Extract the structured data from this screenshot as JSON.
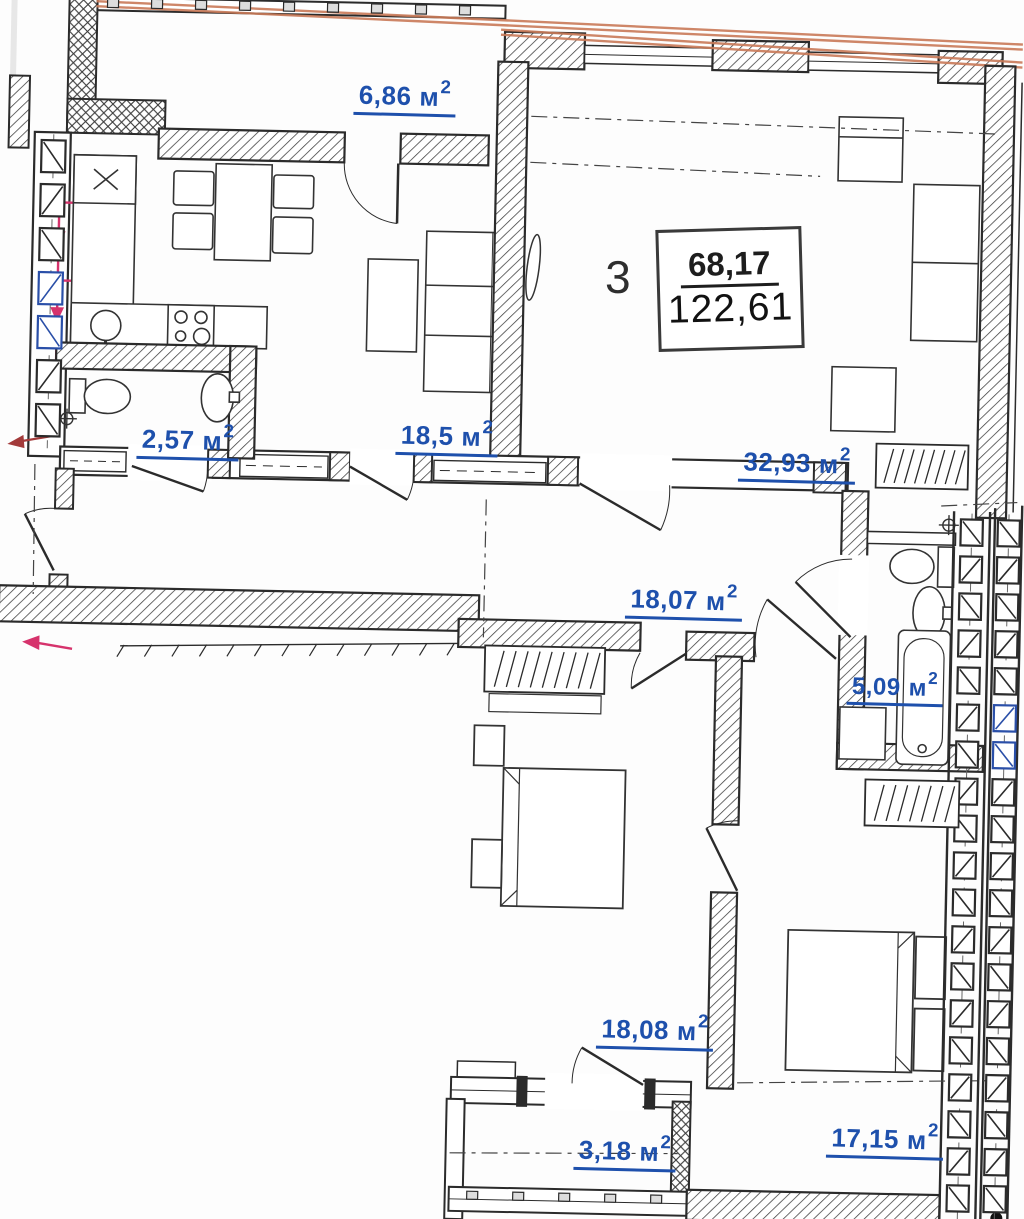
{
  "colors": {
    "area_label_blue": "#1e50ac",
    "facade_line_orange": "#c97a58",
    "plumbing_pink": "#d6336c",
    "entrance_arrow_red": "#a33a3a",
    "window_symbol_blue": "#2a4fa8",
    "drawing_black": "#2b2b2b"
  },
  "sup": "2",
  "apartment": {
    "rooms_count": "3",
    "living_area": "68,17",
    "total_area": "122,61"
  },
  "rooms": {
    "balcony_top": {
      "name": "balcony-top",
      "area": "6,86",
      "unit": "м"
    },
    "wc": {
      "name": "wc",
      "area": "2,57",
      "unit": "м"
    },
    "kitchen_living": {
      "name": "kitchen-living",
      "area": "18,5",
      "unit": "м"
    },
    "living_room": {
      "name": "living-room",
      "area": "32,93",
      "unit": "м"
    },
    "hall": {
      "name": "hall",
      "area": "18,07",
      "unit": "м"
    },
    "bathroom": {
      "name": "bathroom",
      "area": "5,09",
      "unit": "м"
    },
    "bedroom_1": {
      "name": "bedroom-1",
      "area": "18,08",
      "unit": "м"
    },
    "balcony_bottom": {
      "name": "balcony-bottom",
      "area": "3,18",
      "unit": "м"
    },
    "bedroom_2": {
      "name": "bedroom-2",
      "area": "17,15",
      "unit": "м"
    }
  }
}
